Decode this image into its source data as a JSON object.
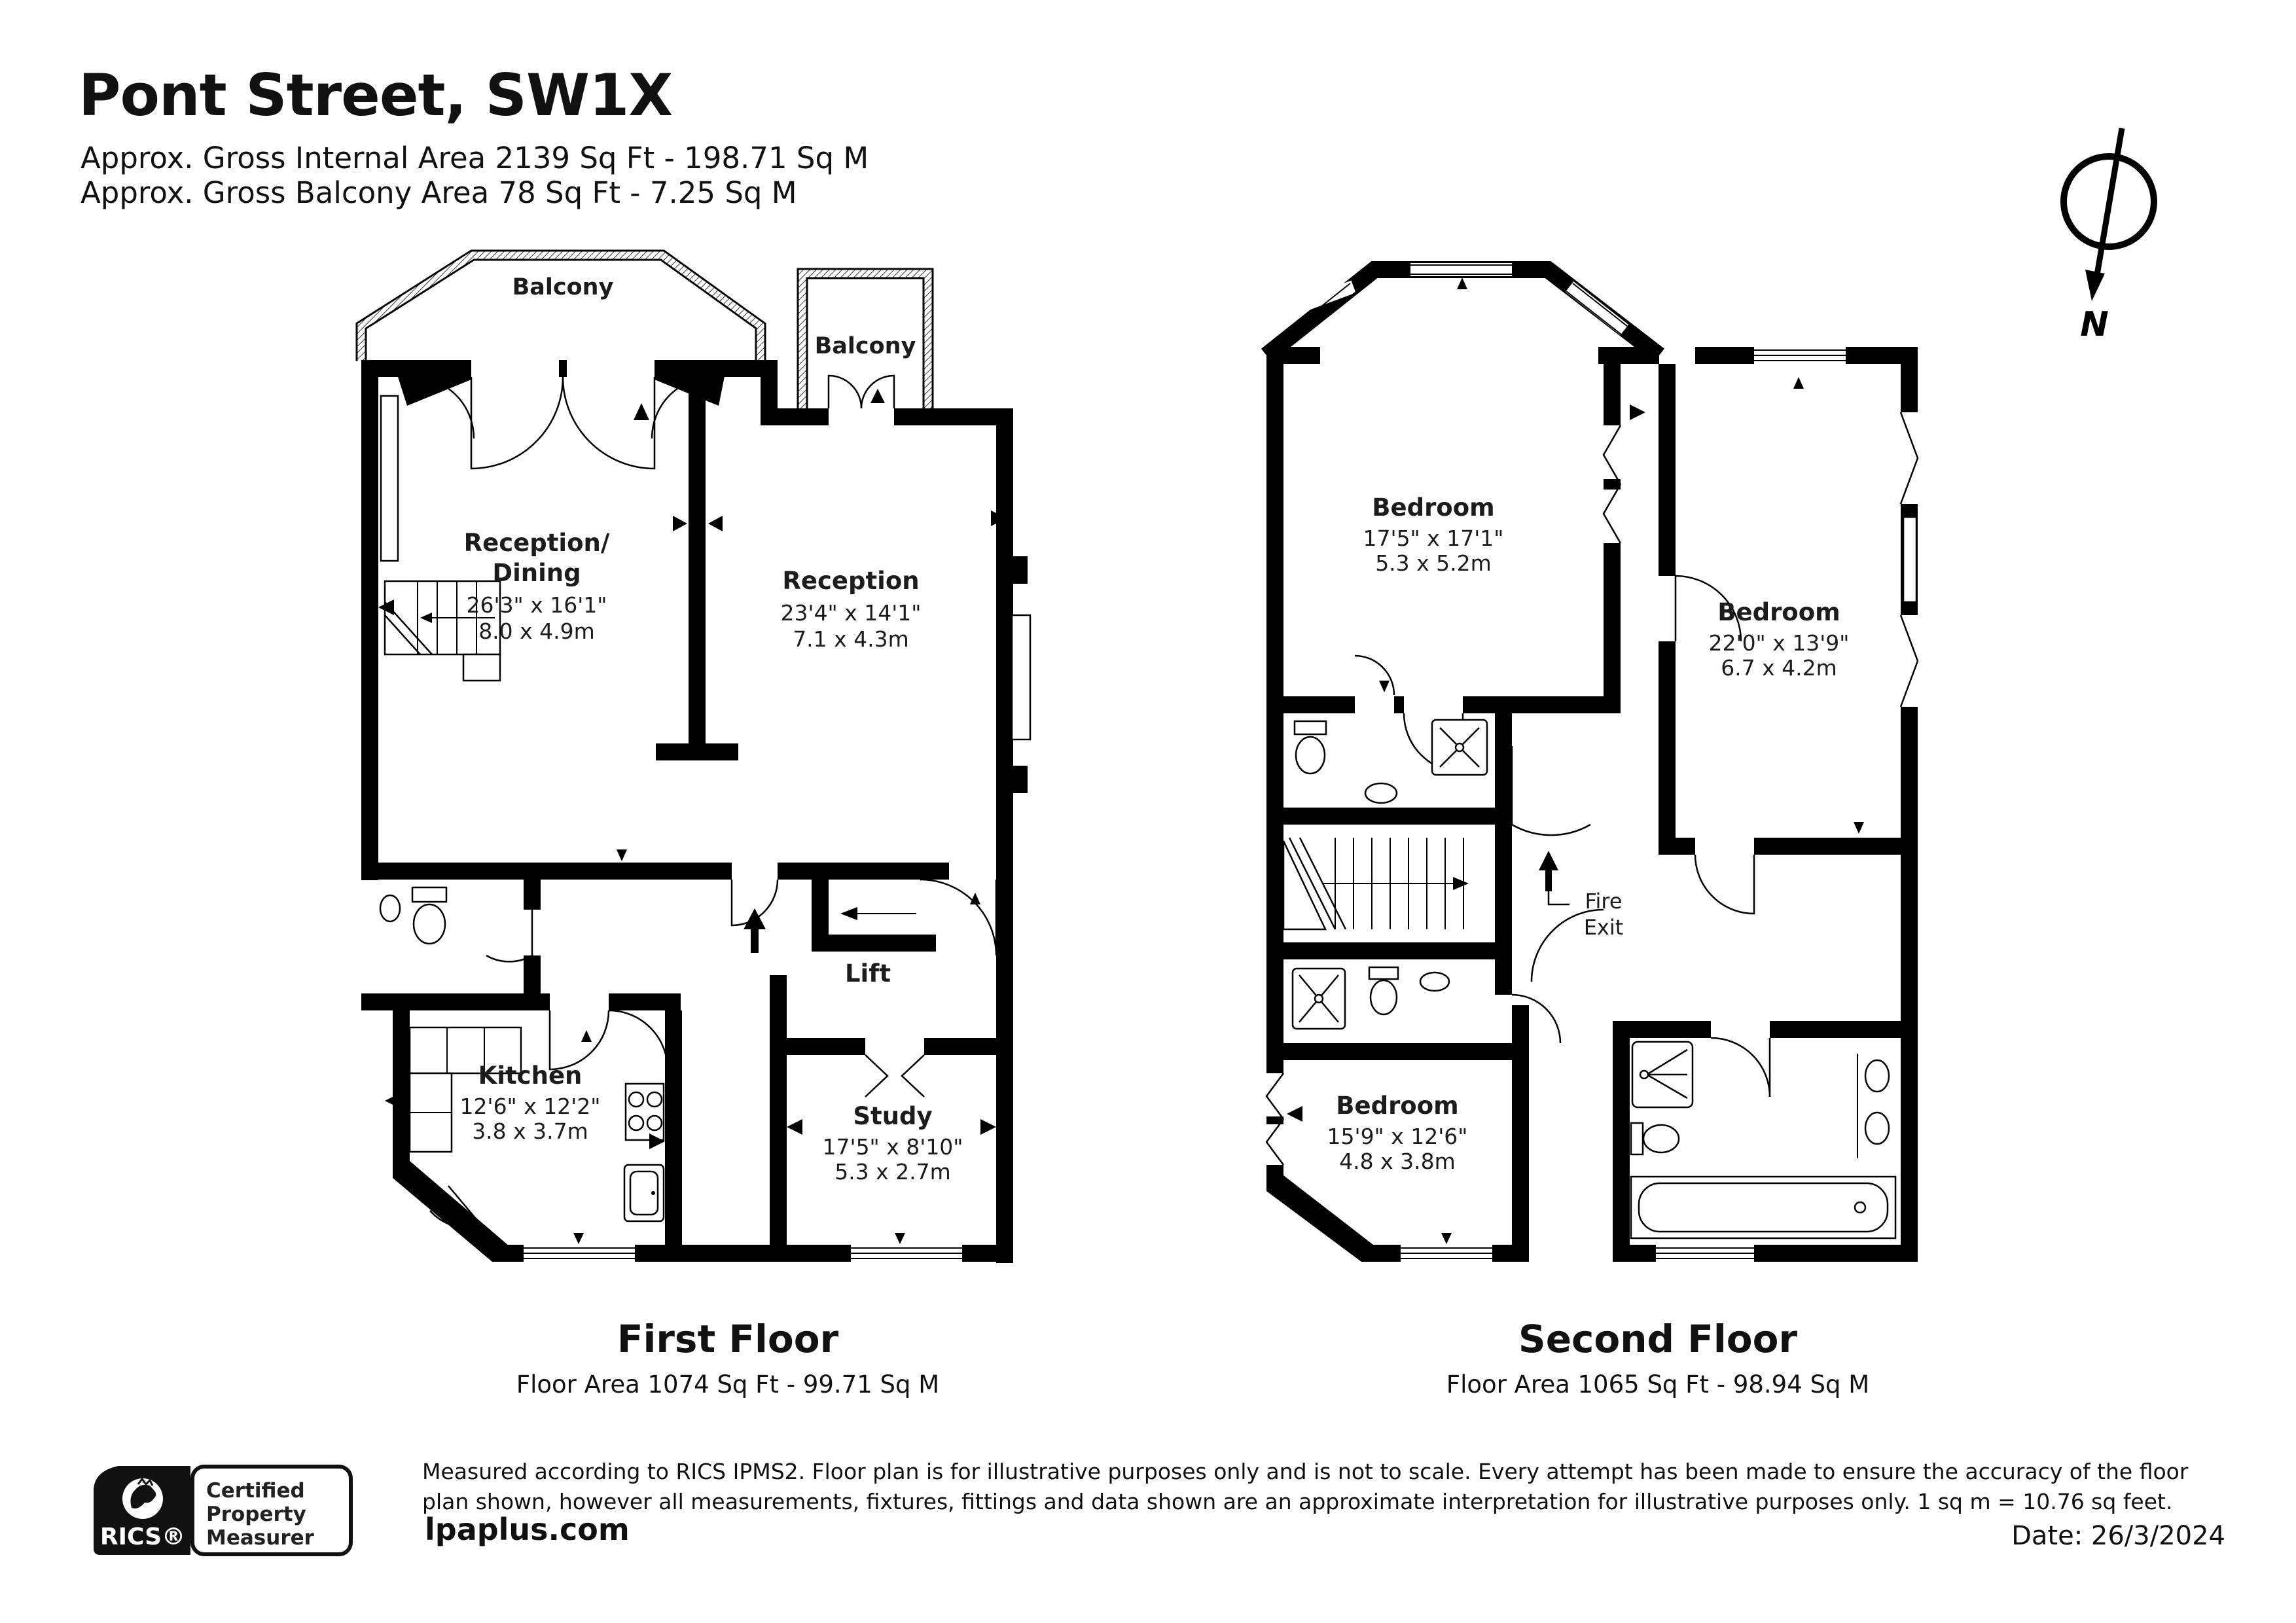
{
  "header": {
    "title": "Pont Street, SW1X",
    "line1": "Approx. Gross Internal Area 2139 Sq Ft - 198.71 Sq M",
    "line2": "Approx. Gross Balcony Area 78 Sq Ft - 7.25 Sq M"
  },
  "compass": {
    "north_label": "N"
  },
  "first_floor": {
    "caption": "First Floor",
    "area": "Floor Area 1074 Sq Ft - 99.71 Sq M",
    "balcony_left": "Balcony",
    "balcony_right": "Balcony",
    "reception_dining": {
      "name_line1": "Reception/",
      "name_line2": "Dining",
      "imperial": "26'3\" x 16'1\"",
      "metric": "8.0 x 4.9m"
    },
    "reception": {
      "name": "Reception",
      "imperial": "23'4\" x 14'1\"",
      "metric": "7.1 x 4.3m"
    },
    "kitchen": {
      "name": "Kitchen",
      "imperial": "12'6\" x 12'2\"",
      "metric": "3.8 x 3.7m"
    },
    "lift": {
      "name": "Lift"
    },
    "study": {
      "name": "Study",
      "imperial": "17'5\" x 8'10\"",
      "metric": "5.3 x 2.7m"
    }
  },
  "second_floor": {
    "caption": "Second Floor",
    "area": "Floor Area 1065 Sq Ft - 98.94 Sq M",
    "bedroom1": {
      "name": "Bedroom",
      "imperial": "17'5\" x 17'1\"",
      "metric": "5.3 x 5.2m"
    },
    "bedroom2": {
      "name": "Bedroom",
      "imperial": "22'0\" x 13'9\"",
      "metric": "6.7 x 4.2m"
    },
    "bedroom3": {
      "name": "Bedroom",
      "imperial": "15'9\" x 12'6\"",
      "metric": "4.8 x 3.8m"
    },
    "fire_exit": {
      "line1": "Fire",
      "line2": "Exit"
    }
  },
  "footer": {
    "rics_label": "RICS®",
    "badge_line1": "Certified",
    "badge_line2": "Property",
    "badge_line3": "Measurer",
    "disclaimer": "Measured according to RICS IPMS2. Floor plan is for illustrative purposes only and is not to scale. Every attempt has been made to ensure the accuracy of the floor plan shown, however all measurements, fixtures, fittings and data shown are an approximate interpretation for illustrative purposes only. 1 sq m = 10.76 sq feet.",
    "website": "lpaplus.com",
    "date": "Date: 26/3/2024"
  }
}
